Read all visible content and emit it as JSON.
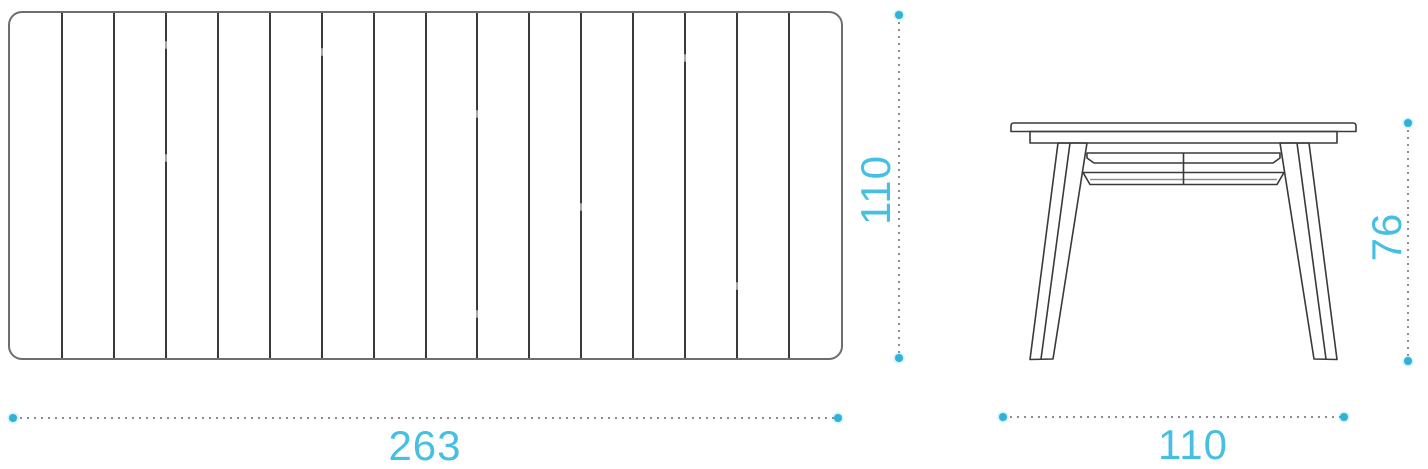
{
  "colors": {
    "background": "#ffffff",
    "accent_text": "#45bfe2",
    "accent_dot": "#2fb2d6",
    "drawing_line": "#3a3a3a",
    "drawing_outline": "#6e6e6e",
    "dotted_line": "#8d8d8d"
  },
  "top_view": {
    "slat_count": 16,
    "joint_marks": [
      {
        "slat": 3,
        "t": 0.08
      },
      {
        "slat": 3,
        "t": 0.41
      },
      {
        "slat": 6,
        "t": 0.1
      },
      {
        "slat": 9,
        "t": 0.28
      },
      {
        "slat": 9,
        "t": 0.86
      },
      {
        "slat": 11,
        "t": 0.55
      },
      {
        "slat": 13,
        "t": 0.12
      },
      {
        "slat": 14,
        "t": 0.78
      }
    ]
  },
  "dimensions": {
    "top_width": {
      "value": "263",
      "orientation": "horizontal"
    },
    "top_depth": {
      "value": "110",
      "orientation": "vertical"
    },
    "front_width": {
      "value": "110",
      "orientation": "horizontal"
    },
    "front_height": {
      "value": "76",
      "orientation": "vertical"
    }
  }
}
